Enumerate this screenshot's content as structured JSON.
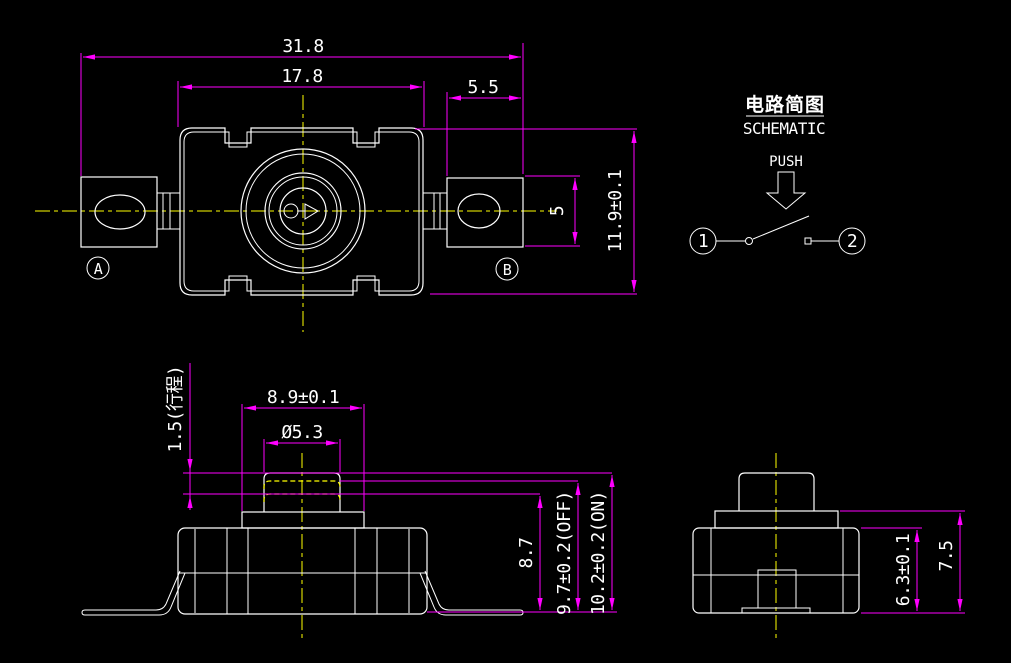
{
  "colors": {
    "background": "#000000",
    "geometry": "#ffffff",
    "dimension": "#ff00ff",
    "centerline": "#ffff00",
    "text": "#ffffff"
  },
  "top_view": {
    "dim_total_width": "31.8",
    "dim_body_width": "17.8",
    "dim_terminal_width": "5.5",
    "dim_body_height": "11.9±0.1",
    "dim_terminal_height": "5",
    "terminal_a_label": "A",
    "terminal_b_label": "B"
  },
  "schematic": {
    "title_cn": "电路简图",
    "title_en": "SCHEMATIC",
    "push_label": "PUSH",
    "terminal_1": "1",
    "terminal_2": "2"
  },
  "side_view": {
    "dim_base_width": "8.9±0.1",
    "dim_button_diameter": "Ø5.3",
    "dim_travel": "1.5(行程)",
    "dim_pressed_height": "8.7",
    "dim_off_height": "9.7±0.2(OFF)",
    "dim_on_height": "10.2±0.2(ON)"
  },
  "end_view": {
    "dim_body_height": "6.3±0.1",
    "dim_total_height": "7.5"
  }
}
